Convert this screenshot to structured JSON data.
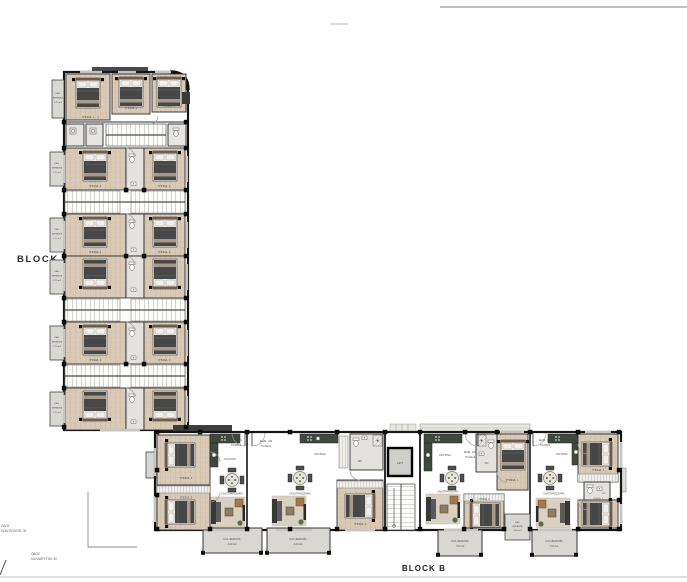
{
  "labels": {
    "block_a": "BLOCK A",
    "block_b": "BLOCK B"
  },
  "streets": {
    "left": {
      "line1": "ΟΔΟΣ",
      "line2": "ΚΩΝ/ΠΟΛΕΩΣ 30"
    },
    "bottom": {
      "line1": "ΟΔΟΣ",
      "line2": "ΚΑΛΑΒΡΥΤΩΝ 30"
    }
  },
  "rooms": {
    "bedroom1": "ΥΠΝΟΔ. 1",
    "bedroom2": "ΥΠΝΟΔ. 2",
    "kitchen": "ΚΟΥΖΙΝΑ",
    "living_dining": "ΣΑΛΟΤΡΑΠΕΖΑΡΙΑ",
    "veranda": "ΚΑΛ. ΒΕΡΑΝΤΑ",
    "veranda_line1": "ΚΑΛ.",
    "veranda_line2": "ΒΕΡΑΝΤΑ",
    "wc": "WC",
    "lift": "LIFT"
  },
  "verandas": {
    "area_small": "3.75 m2",
    "area_4": "4.00 m2",
    "area_7": "7.00 m2"
  },
  "apartments": [
    {
      "id": "ΔΙΑΜ. 101",
      "area": "73.00m2"
    },
    {
      "id": "ΔΙΑΜ. 102",
      "area": "73.00m2"
    },
    {
      "id": "ΔΙΑΜ. 103",
      "area": "70.00m2"
    },
    {
      "id": "ΔΙΑΜ. 104",
      "area": "73.00m2"
    }
  ],
  "colors": {
    "wall": "#161616",
    "wood_floor": "#d9cab7",
    "tile_floor": "#e3e2df",
    "interior_floor": "#f1f0ee",
    "veranda": "#d8d7d3",
    "kitchen_counter": "#3f483f",
    "bed_duvet": "#474747",
    "accent_wood": "#a4774f",
    "label_text": "#4a4a4a"
  }
}
